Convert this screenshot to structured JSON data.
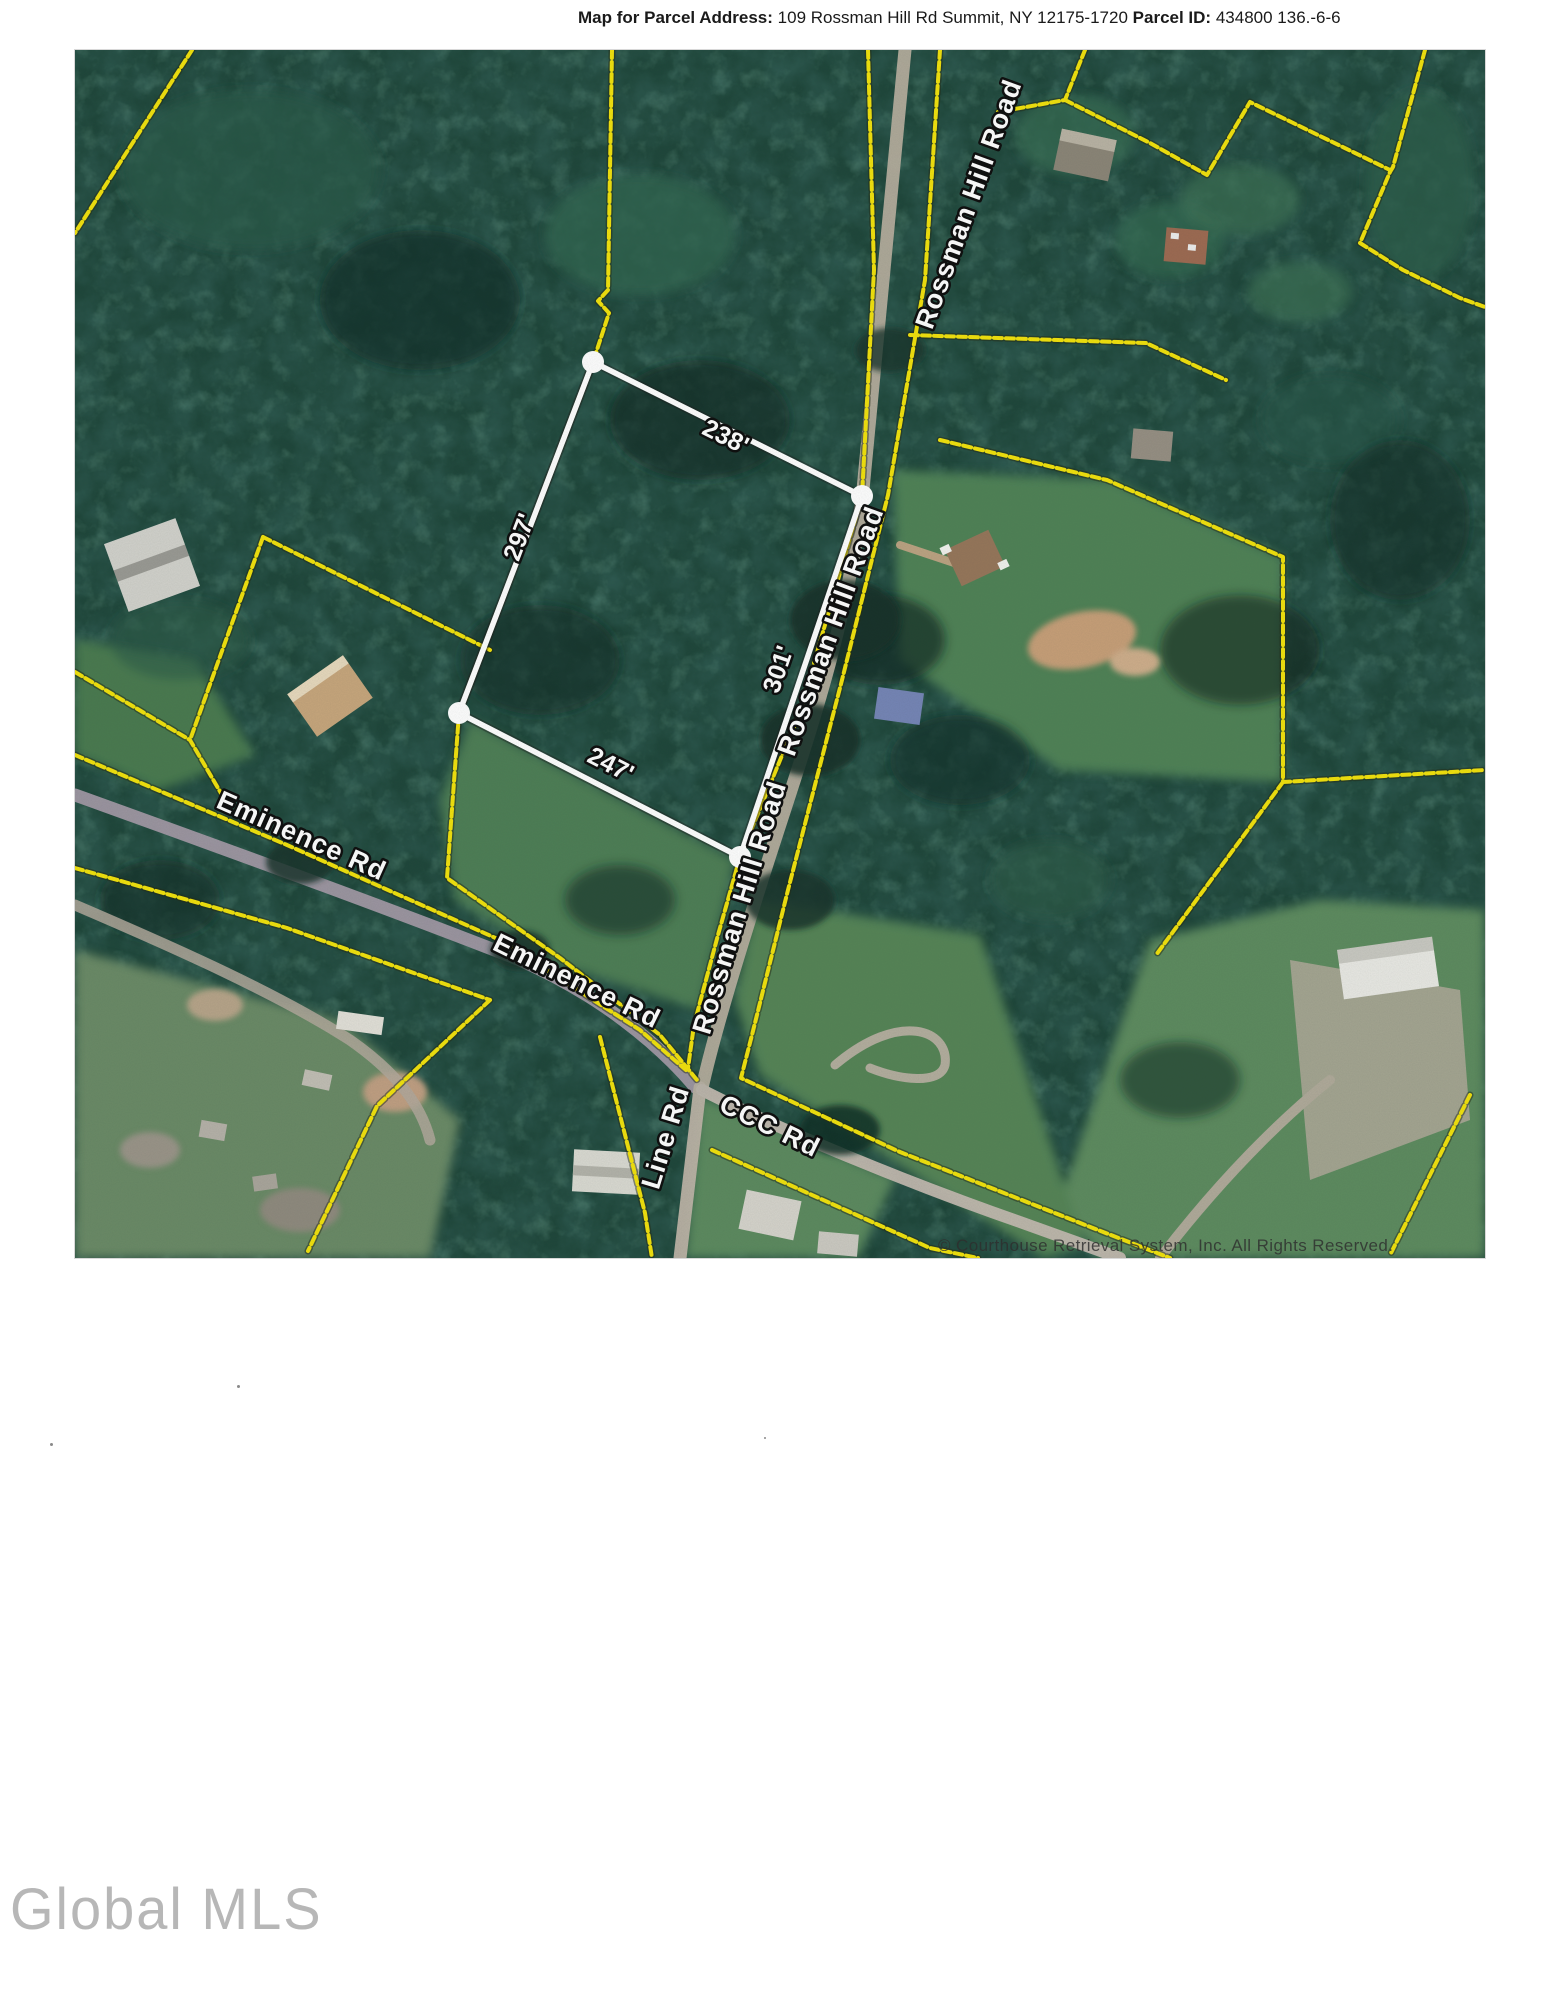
{
  "header": {
    "label_address": "Map for Parcel Address:",
    "address": "109 Rossman Hill Rd Summit, NY 12175-1720",
    "label_parcel_id": "Parcel ID:",
    "parcel_id": "434800 136.-6-6"
  },
  "map": {
    "parcel_dimensions": {
      "top": "238'",
      "left": "297'",
      "right": "301'",
      "bottom": "247'"
    },
    "road_labels": {
      "rossman_top": "Rossman Hill Road",
      "rossman_middle": "Rossman Hill Road",
      "rossman_lower": "Rossman Hill Road",
      "eminence_upper": "Eminence Rd",
      "eminence_lower": "Eminence Rd",
      "line_rd": "Line Rd",
      "ccc_rd": "CCC Rd"
    },
    "copyright": "© Courthouse Retrieval System, Inc. All Rights Reserved.",
    "colors": {
      "boundary_yellow": "#f2e20c",
      "parcel_outline": "#ffffff",
      "forest_base": "#1e463a",
      "field_green": "#4f8257",
      "road_gray": "#b7ae9f"
    }
  },
  "footer": {
    "logo": "Global MLS"
  }
}
